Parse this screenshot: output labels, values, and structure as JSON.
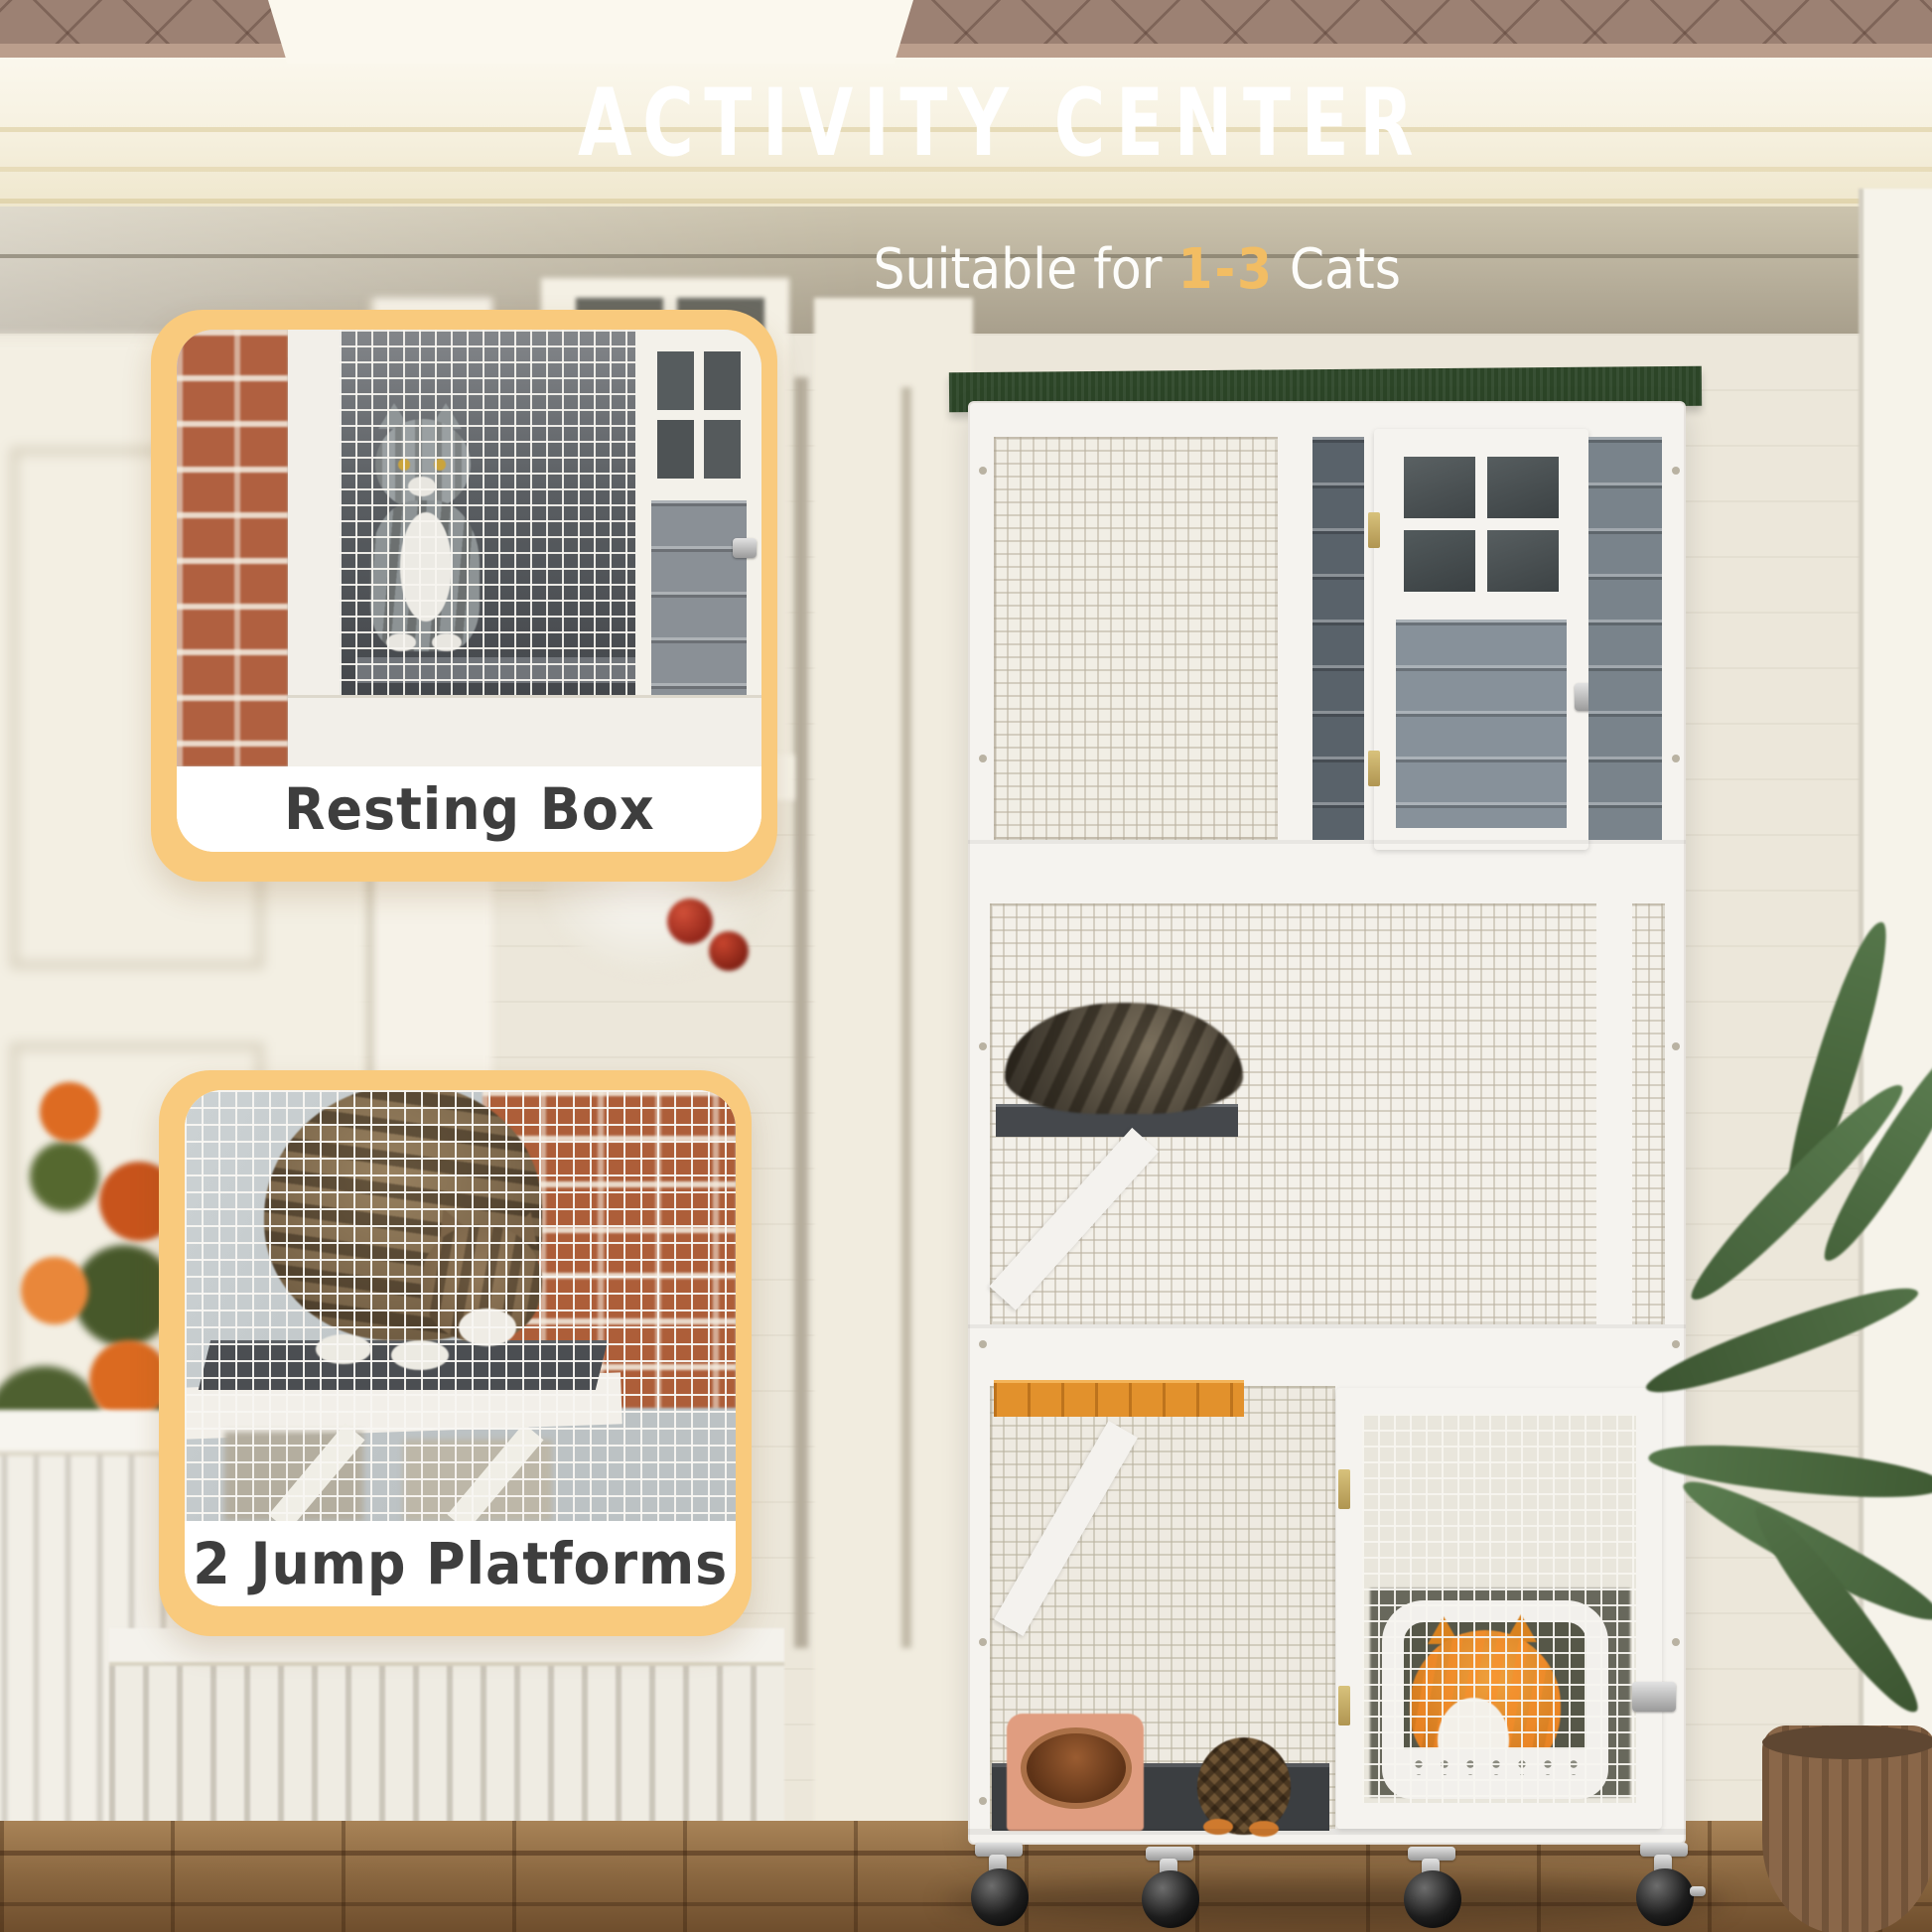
{
  "header": {
    "title": "ACTIVITY CENTER",
    "subtitle": {
      "prefix": "Suitable for ",
      "highlight": "1-3",
      "suffix": " Cats"
    }
  },
  "callouts": [
    {
      "label": "Resting Box"
    },
    {
      "label": "2 Jump Platforms"
    }
  ],
  "colors": {
    "accent_orange_border": "#F9CA7D",
    "highlight_orange_text": "#F2BD63",
    "callout_label_text": "#3E3E3E",
    "headline_text": "#FFFFFF",
    "catio_roof_green": "#2C4527",
    "catio_frame_white": "#F5F3EF"
  }
}
